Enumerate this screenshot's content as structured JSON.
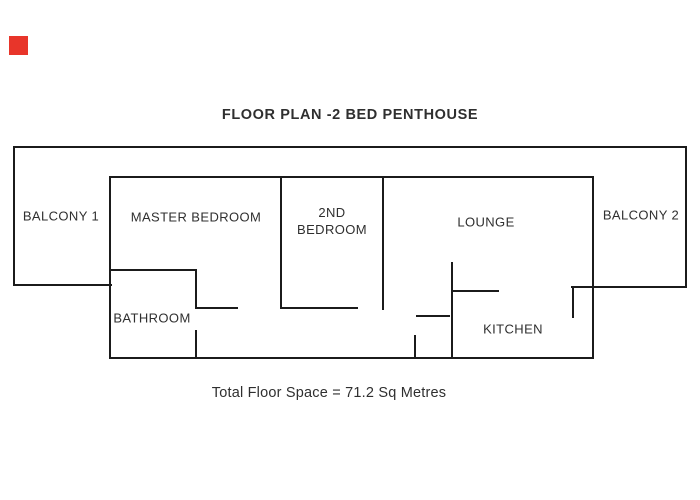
{
  "title": "FLOOR PLAN -2 BED PENTHOUSE",
  "footer": "Total Floor Space = 71.2 Sq Metres",
  "rooms": {
    "balcony_1": "BALCONY 1",
    "master_bedroom": "MASTER BEDROOM",
    "second_bedroom": {
      "line1": "2ND",
      "line2": "BEDROOM"
    },
    "lounge": "LOUNGE",
    "balcony_2": "BALCONY 2",
    "bathroom": "BATHROOM",
    "kitchen": "KITCHEN"
  },
  "marker": {
    "color": "#e8352a"
  },
  "colors": {
    "background": "#ffffff",
    "wall": "#1b1b1b",
    "text": "#2f2f2f"
  }
}
